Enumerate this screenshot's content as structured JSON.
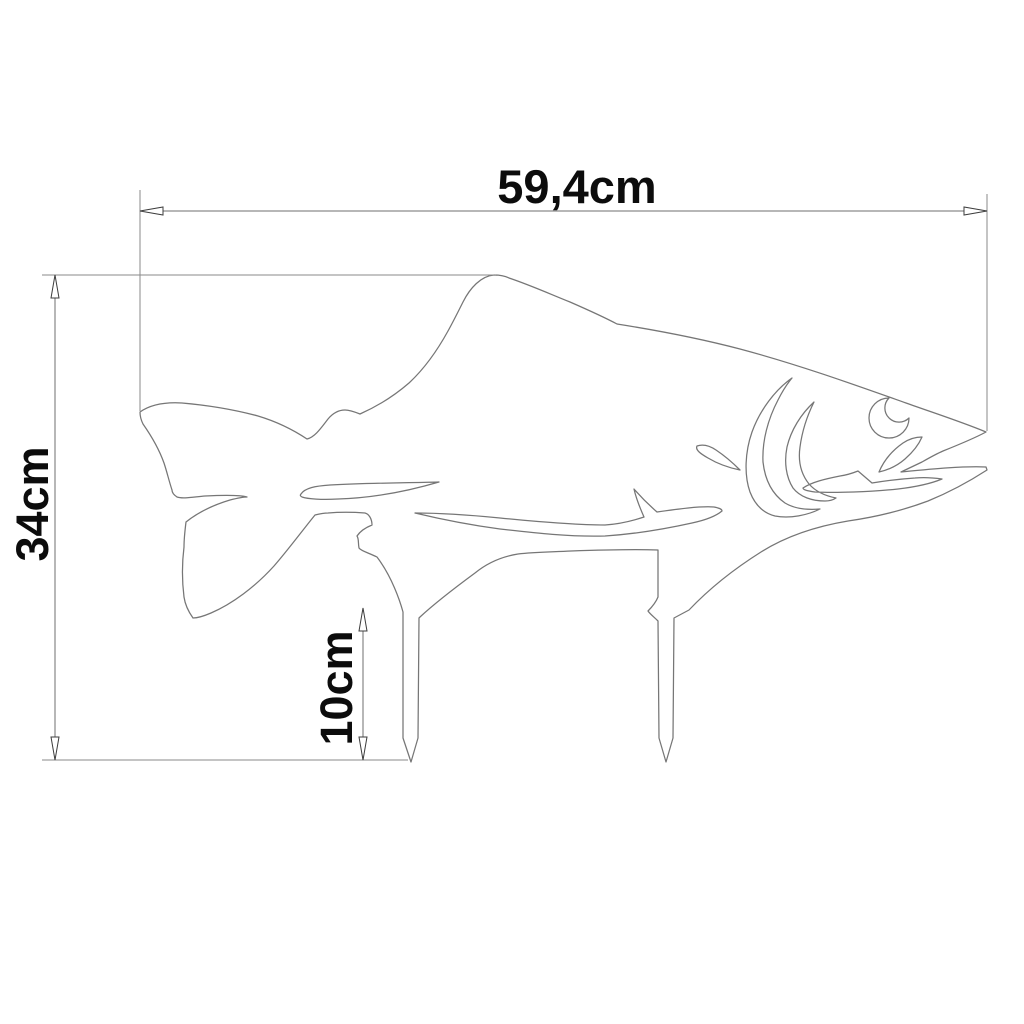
{
  "drawing": {
    "type": "dimensioned technical drawing of fish-shaped garden stake",
    "dimensions": {
      "width": {
        "label": "59,4cm"
      },
      "height": {
        "label": "34cm"
      },
      "stake": {
        "label": "10cm"
      }
    },
    "colors": {
      "background": "#ffffff",
      "outline": "#767676",
      "dimension_line": "#6f6f6f",
      "extension_line": "#8a8a8a",
      "arrow_stroke": "#3c3c3c",
      "arrow_fill": "#ffffff",
      "text": "#0c0c0c"
    }
  }
}
